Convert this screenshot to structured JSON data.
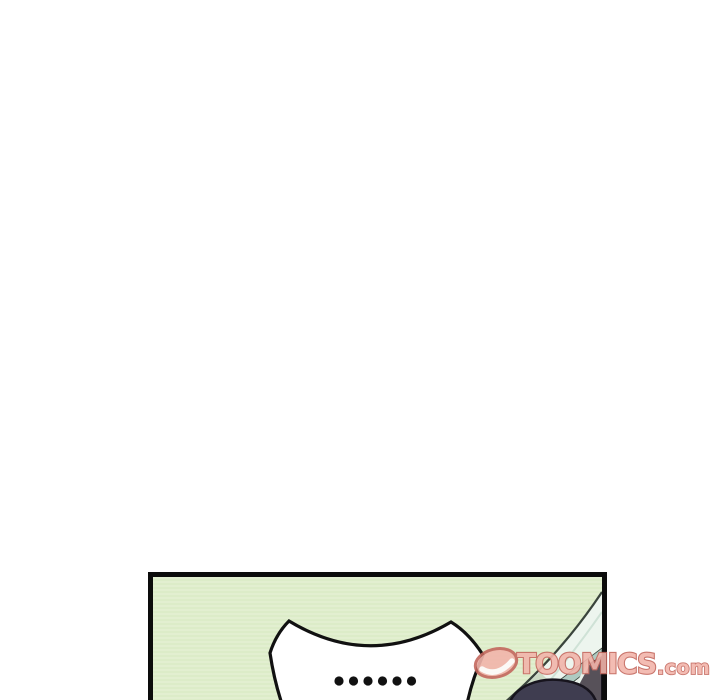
{
  "page": {
    "type": "webtoon-comic-page",
    "background": "#ffffff"
  },
  "comic": {
    "panel": {
      "background_color": "#dcecc8",
      "border_color": "#0c0c0c",
      "speech_bubble": {
        "dialogue": "……",
        "dot_count": 6,
        "fill": "#ffffff",
        "outline": "#111111"
      },
      "scene": {
        "window_glass": "diagonal glass pane, bottom-right corner",
        "character_head": "top of dark-haired head at bottom edge"
      }
    }
  },
  "watermark": {
    "brand": "TOOMICS",
    "domain": ".com",
    "logo": "toomics-eye-logo",
    "fill_color": "#f2b5ab",
    "outline_color": "#c4685e"
  },
  "colors": {
    "panel_green_a": "#dcecc8",
    "panel_green_b": "#e8f3d8",
    "panel_border": "#0c0c0c",
    "ink": "#111111",
    "bubble_fill": "#ffffff",
    "glass": "#edf5ee",
    "glass_line": "#3a443c",
    "glass_faint": "#cfe2d6",
    "glass_band": "#aecac1",
    "glass_sliver": "#e9f3eb",
    "shadow_sage": "#b8cbad",
    "head": "#3f3d50",
    "head_outline": "#17141d",
    "corner_gray": "#575159",
    "wm_fill": "#f2b5ab",
    "wm_stroke": "#c4685e"
  }
}
